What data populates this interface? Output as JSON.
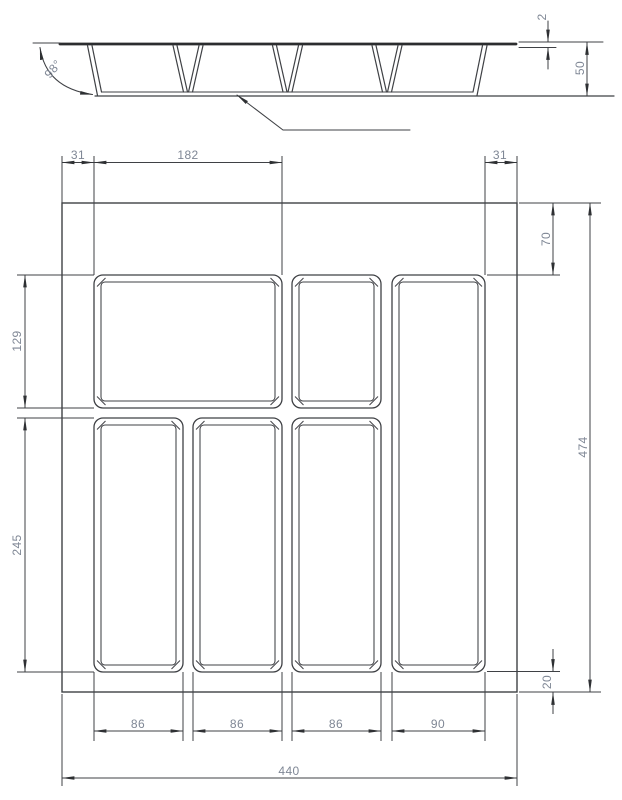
{
  "drawing": {
    "kind": "CAD technical drawing — cutlery tray drawer insert (section view and plan view)",
    "units": "mm",
    "line_color": "#3f4145",
    "dim_text_color": "#7f8795",
    "section": {
      "draft_angle": "98°",
      "top_thickness": "2",
      "height": "50"
    },
    "plan": {
      "left_margin": "31",
      "large_compartment_width": "182",
      "right_margin": "31",
      "top_row_height": "129",
      "bottom_row_height": "245",
      "right_top_offset": "70",
      "overall_height": "474",
      "bottom_offset": "20",
      "column_widths": [
        "86",
        "86",
        "86",
        "90"
      ],
      "overall_width": "440"
    }
  }
}
